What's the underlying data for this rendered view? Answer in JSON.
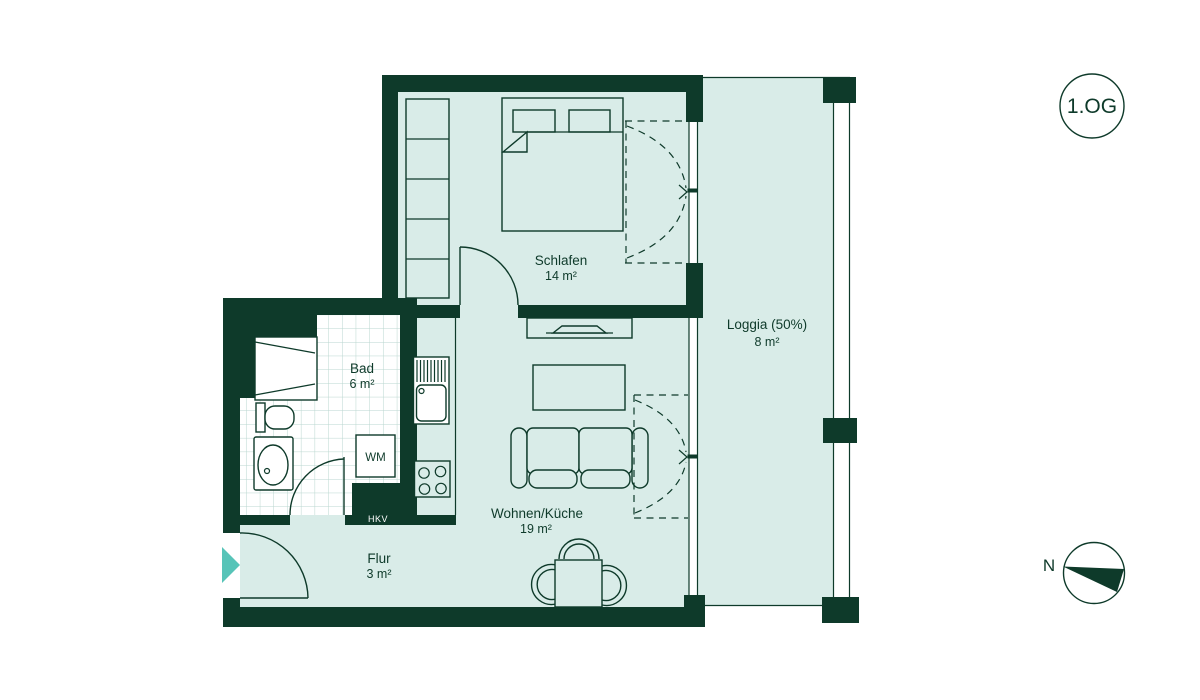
{
  "floor_badge": "1.OG",
  "compass": {
    "north_label": "N"
  },
  "rooms": [
    {
      "name": "Schlafen",
      "area": "14 m²"
    },
    {
      "name": "Bad",
      "area": "6 m²"
    },
    {
      "name": "Wohnen/Küche",
      "area": "19 m²"
    },
    {
      "name": "Flur",
      "area": "3 m²"
    },
    {
      "name": "Loggia (50%)",
      "area": "8 m²"
    }
  ],
  "appliances": {
    "washing_machine": "WM",
    "heating_manifold": "HKV"
  },
  "colors": {
    "ink": "#0e3a2a",
    "floor": "#d9ece8",
    "tile_grid": "#b9d6cf",
    "white": "#ffffff",
    "accent": "#57c4b8",
    "background": "#ffffff"
  }
}
